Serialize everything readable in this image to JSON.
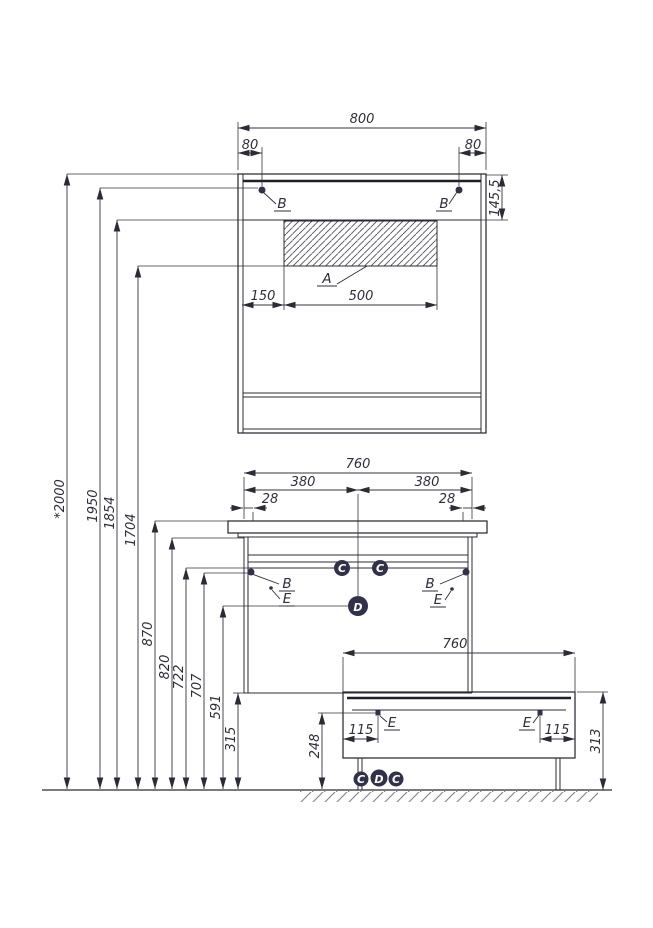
{
  "mirror_cabinet": {
    "width": "800",
    "mount_offset_left": "80",
    "mount_offset_right": "80",
    "top_section_height": "145,5",
    "mount_point_left": "B",
    "mount_point_right": "B",
    "panel_label": "A",
    "panel_left_offset": "150",
    "panel_width": "500"
  },
  "vanity_cabinet": {
    "width": "760",
    "center_left": "380",
    "center_right": "380",
    "edge_offset_left": "28",
    "edge_offset_right": "28",
    "mount_point_left": "B",
    "mount_point_right": "B",
    "clip_left": "C",
    "clip_right": "C",
    "center_point": "D",
    "hook_left": "E",
    "hook_right": "E"
  },
  "base_unit": {
    "width": "760",
    "hook_offset_left": "115",
    "hook_offset_right": "115",
    "height": "313",
    "hook_left": "E",
    "hook_right": "E",
    "point_c_left": "C",
    "point_d": "D",
    "point_c_right": "C"
  },
  "heights": {
    "overall": "*2000",
    "mirror_mount": "1950",
    "panel_top": "1854",
    "panel_bottom": "1704",
    "countertop": "870",
    "countertop_bottom": "820",
    "rail": "722",
    "side_mount": "707",
    "center_point": "591",
    "cabinet_bottom": "315",
    "base_hook": "248"
  }
}
